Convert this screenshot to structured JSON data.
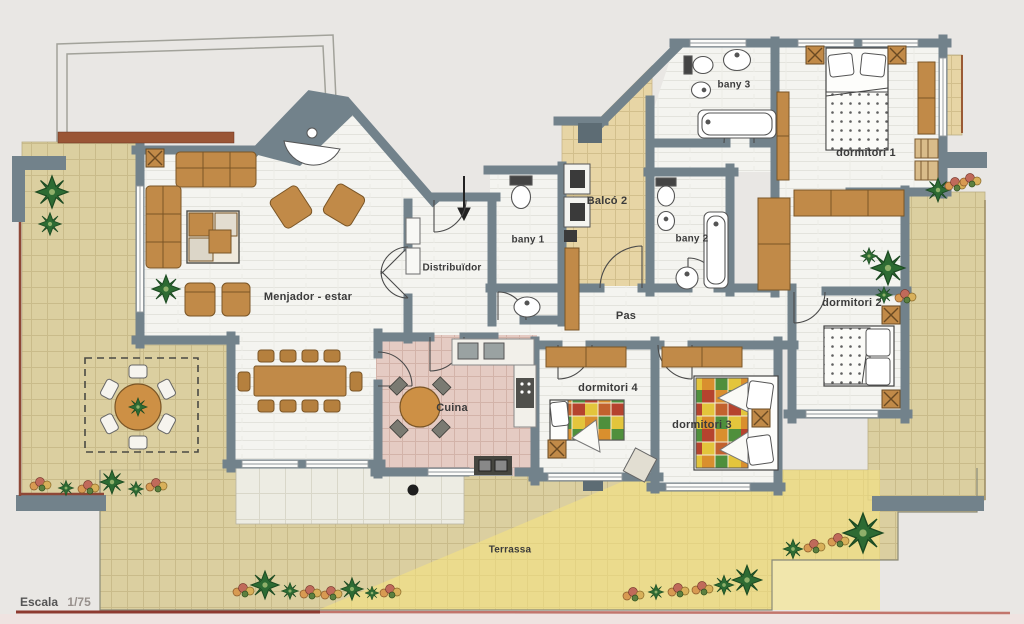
{
  "floorplan": {
    "rooms": {
      "menjador_estar": "Menjador - estar",
      "distribuidor": "Distribuïdor",
      "bany_1": "bany 1",
      "balco_2": "Balcó 2",
      "bany_2": "bany 2",
      "bany_3": "bany 3",
      "dormitori_1": "dormitori 1",
      "dormitori_2": "dormitori 2",
      "dormitori_3": "dormitori 3",
      "dormitori_4": "dormitori 4",
      "cuina": "Cuina",
      "pas": "Pas",
      "terrassa": "Terrassa"
    },
    "scale_word": "Escala",
    "scale_value": "1/75",
    "icons": {
      "entry_arrow": "↓",
      "plant": "✳",
      "flowers": "❀"
    },
    "colors": {
      "background": "#e9e7e4",
      "wall": "#72828b",
      "room_floor": "#f4f4f0",
      "kitchen_tile": "#e5cbc3",
      "balcony_tile": "#e7d5a5",
      "terrace_tile": "#dbcfa0",
      "sunlight": "#f8e57d",
      "furniture_wood": "#c18a48",
      "plant_green": "#2d6b33",
      "railing_red": "#8e4736",
      "scale_underline": "#8e3a30"
    }
  }
}
